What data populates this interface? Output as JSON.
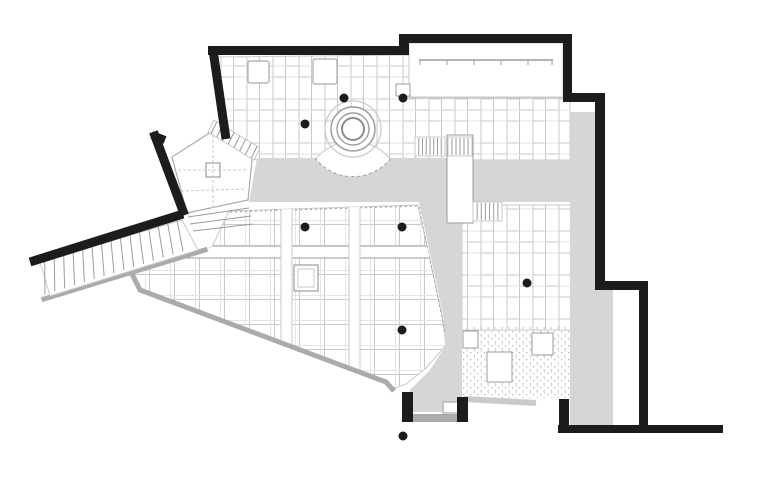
{
  "meta": {
    "content": "architectural floor plan drawing",
    "visible_text": "none"
  },
  "canvas": {
    "width": 768,
    "height": 501,
    "background": "#ffffff"
  },
  "palette": {
    "wall_black": "#1c1c1c",
    "corridor_gray": "#d4d6d8",
    "wall_gray": "#a9abad",
    "shadow_gray": "#c8cacc",
    "line_light": "#c7c9cb",
    "line_lighter": "#e3e5e7",
    "line_mid": "#9a9c9e",
    "stipple_dot": "#b4b6b8",
    "white": "#ffffff"
  },
  "clips": {
    "hall": "M229 211 L418 205 L442 315 L446 345 L426 368 L406 384 L396 388 L140 290 L131 272 L203 251 L212 247 Z"
  },
  "elements": [
    {
      "name": "counter-room-floor",
      "kind": "rect",
      "x": 409,
      "y": 43,
      "w": 154,
      "h": 54,
      "fill": "#ffffff",
      "stroke": "line_light",
      "sw": 1
    },
    {
      "name": "upper-hall-floor",
      "kind": "path",
      "d": "M218 57 L409 55 L409 98 L570 98 L570 160 L391 160 A48 48 0 0 0 315 160 L257 160 L227 141 Z",
      "fill": "pattern:planks",
      "stroke": "line_light",
      "sw": 1
    },
    {
      "name": "right-room-floor",
      "kind": "rect",
      "x": 462,
      "y": 205,
      "w": 110,
      "h": 125,
      "fill": "pattern:planks",
      "stroke": "line_light",
      "sw": 1
    },
    {
      "name": "main-hall-floor",
      "kind": "path",
      "d": "M229 211 L418 205 L442 315 L446 345 L426 368 L406 384 L396 388 L140 290 L131 272 L203 251 L212 247 Z",
      "fill": "pattern:grid",
      "stroke": "line_light",
      "sw": 1
    },
    {
      "name": "terrace-stipple-floor",
      "kind": "rect",
      "x": 461,
      "y": 327,
      "w": 111,
      "h": 71,
      "fill": "pattern:stipple"
    },
    {
      "name": "pentagon-room-floor",
      "kind": "path",
      "d": "M172 157 L222 125 L253 150 L248 200 L187 213 Z",
      "fill": "#ffffff",
      "stroke": "wall_gray",
      "sw": 1.2
    },
    {
      "name": "corridor-band-west",
      "kind": "path",
      "d": "M257 158 L315 158 A48 48 0 0 0 391 158 L447 158 L447 202 L249 202 Z",
      "fill": "corridor_gray"
    },
    {
      "name": "corridor-band-east",
      "kind": "rect",
      "x": 472,
      "y": 160,
      "w": 98,
      "h": 42,
      "fill": "corridor_gray"
    },
    {
      "name": "corridor-strip-east",
      "kind": "path",
      "d": "M570 112 L595 112 L595 290 L613 290 L613 425 L570 425 Z",
      "fill": "corridor_gray"
    },
    {
      "name": "corridor-central",
      "kind": "path",
      "d": "M419 202 L462 202 L462 412 L412 412 L410 390 L430 370 L446 345 L443 315 Z",
      "fill": "corridor_gray"
    },
    {
      "name": "hall-north-dashed-edge",
      "kind": "line",
      "x1": 230,
      "y1": 212,
      "x2": 418,
      "y2": 206,
      "stroke": "line_mid",
      "sw": 1,
      "dash": "2 3"
    },
    {
      "name": "hall-east-dashed-edge",
      "kind": "line",
      "x1": 419,
      "y1": 207,
      "x2": 445,
      "y2": 332,
      "stroke": "line_mid",
      "sw": 1,
      "dash": "2 3"
    },
    {
      "name": "hall-beam-horizontal",
      "kind": "rect",
      "x": 140,
      "y": 246,
      "w": 308,
      "h": 12,
      "fill": "#ffffff",
      "stroke": "line_mid",
      "sw": 1,
      "clip": "hall"
    },
    {
      "name": "hall-beam-vertical-west",
      "kind": "rect",
      "x": 281,
      "y": 206,
      "w": 11,
      "h": 180,
      "fill": "#ffffff",
      "stroke": "line_light",
      "sw": 1,
      "clip": "hall"
    },
    {
      "name": "hall-beam-vertical-east",
      "kind": "rect",
      "x": 349,
      "y": 205,
      "w": 11,
      "h": 182,
      "fill": "#ffffff",
      "stroke": "line_light",
      "sw": 1,
      "clip": "hall"
    },
    {
      "name": "rotunda-dashed-arc",
      "kind": "path",
      "d": "M315 158 A48 48 0 0 0 391 158",
      "fill": null,
      "stroke": "line_mid",
      "sw": 1,
      "dash": "3 3"
    },
    {
      "name": "rotunda-outer-circle",
      "kind": "circle",
      "cx": 353,
      "cy": 129,
      "r": 28,
      "fill": "none",
      "stroke": "line_light",
      "sw": 1.2
    },
    {
      "name": "rotunda-ring-circle",
      "kind": "circle",
      "cx": 353,
      "cy": 129,
      "r": 22,
      "fill": "#ffffff",
      "stroke": "line_mid",
      "sw": 1.4
    },
    {
      "name": "rotunda-mid-circle",
      "kind": "circle",
      "cx": 353,
      "cy": 129,
      "r": 16,
      "fill": "#ffffff",
      "stroke": "line_mid",
      "sw": 1.4
    },
    {
      "name": "rotunda-inner-circle",
      "kind": "circle",
      "cx": 353,
      "cy": 129,
      "r": 11,
      "fill": "#ffffff",
      "stroke": "#8a8c8e",
      "sw": 2
    },
    {
      "name": "ramp-lower-wall",
      "kind": "line",
      "x1": 44,
      "y1": 299,
      "x2": 205,
      "y2": 250,
      "stroke": "wall_gray",
      "sw": 5,
      "cap": "square"
    },
    {
      "name": "hall-lower-wall",
      "kind": "polyline",
      "pts": "131,272 140,290 386,382 394,391",
      "stroke": "wall_gray",
      "sw": 5
    },
    {
      "name": "vestibule-threshold",
      "kind": "line",
      "x1": 413,
      "y1": 418,
      "x2": 459,
      "y2": 418,
      "stroke": "wall_gray",
      "sw": 8
    },
    {
      "name": "entry-shadow-line",
      "kind": "line",
      "x1": 464,
      "y1": 399,
      "x2": 536,
      "y2": 403,
      "stroke": "shadow_gray",
      "sw": 6
    },
    {
      "name": "ramp-stair-hatch",
      "kind": "hatch",
      "quad": [
        [
          40,
          262
        ],
        [
          182,
          220
        ],
        [
          198,
          250
        ],
        [
          50,
          296
        ]
      ],
      "n": 15,
      "slant": -10,
      "fill": "#ffffff",
      "stroke": "line_light",
      "lineStroke": "line_mid"
    },
    {
      "name": "pentagon-stair-hatch",
      "kind": "hatch",
      "quad": [
        [
          214,
          120
        ],
        [
          260,
          148
        ],
        [
          254,
          160
        ],
        [
          208,
          132
        ]
      ],
      "n": 8,
      "slant": 0,
      "fill": "#ffffff",
      "stroke": "line_light",
      "lineStroke": "line_mid"
    },
    {
      "name": "pentagon-lower-steps",
      "kind": "path",
      "d": "M188 217 L249 208 M190 224 L251 216 M193 231 L253 224",
      "fill": null,
      "stroke": "line_mid",
      "sw": 1
    },
    {
      "name": "bridge-walkway",
      "kind": "rect",
      "x": 447,
      "y": 135,
      "w": 26,
      "h": 88,
      "fill": "#ffffff",
      "stroke": "line_mid",
      "sw": 1
    },
    {
      "name": "bridge-west-steps",
      "kind": "vlines",
      "x": 415,
      "y": 137,
      "w": 30,
      "h": 19,
      "n": 7
    },
    {
      "name": "bridge-top-steps",
      "kind": "vlines",
      "x": 448,
      "y": 137,
      "w": 24,
      "h": 19,
      "n": 5
    },
    {
      "name": "right-room-steps",
      "kind": "vlines",
      "x": 473,
      "y": 202,
      "w": 29,
      "h": 19,
      "n": 6
    },
    {
      "name": "upper-hall-table-west",
      "kind": "rect",
      "x": 248,
      "y": 61,
      "w": 21,
      "h": 22,
      "rx": 2,
      "fill": "#ffffff",
      "stroke": "wall_gray",
      "sw": 1.2
    },
    {
      "name": "upper-hall-table-east",
      "kind": "rect",
      "x": 313,
      "y": 59,
      "w": 24,
      "h": 25,
      "rx": 2,
      "fill": "#ffffff",
      "stroke": "wall_gray",
      "sw": 1.2
    },
    {
      "name": "upper-hall-table-small",
      "kind": "rect",
      "x": 396,
      "y": 84,
      "w": 14,
      "h": 12,
      "fill": "#ffffff",
      "stroke": "line_mid",
      "sw": 1
    },
    {
      "name": "hall-center-table",
      "kind": "rect",
      "x": 294,
      "y": 265,
      "w": 24,
      "h": 26,
      "fill": "#ffffff",
      "stroke": "line_mid",
      "sw": 1.2
    },
    {
      "name": "hall-center-table-inner",
      "kind": "rect",
      "x": 298,
      "y": 269,
      "w": 16,
      "h": 18,
      "fill": "#ffffff",
      "stroke": "line_light",
      "sw": 1
    },
    {
      "name": "pentagon-table",
      "kind": "rect",
      "x": 206,
      "y": 163,
      "w": 14,
      "h": 14,
      "fill": "#ffffff",
      "stroke": "line_mid",
      "sw": 1.2
    },
    {
      "name": "pentagon-guide-dashes",
      "kind": "path",
      "d": "M178 170 L246 170 M213 130 L213 208 M181 191 L246 189",
      "fill": null,
      "stroke": "line_light",
      "sw": 1,
      "dash": "3 2"
    },
    {
      "name": "terrace-table-large",
      "kind": "rect",
      "x": 487,
      "y": 352,
      "w": 25,
      "h": 30,
      "fill": "#ffffff",
      "stroke": "line_mid",
      "sw": 1
    },
    {
      "name": "terrace-table-mid",
      "kind": "rect",
      "x": 532,
      "y": 333,
      "w": 21,
      "h": 22,
      "fill": "#ffffff",
      "stroke": "line_mid",
      "sw": 1
    },
    {
      "name": "terrace-table-small",
      "kind": "rect",
      "x": 463,
      "y": 331,
      "w": 15,
      "h": 17,
      "fill": "#ffffff",
      "stroke": "line_mid",
      "sw": 1
    },
    {
      "name": "entry-door-leaf",
      "kind": "rect",
      "x": 443,
      "y": 402,
      "w": 15,
      "h": 11,
      "fill": "#ffffff",
      "stroke": "line_mid",
      "sw": 1
    },
    {
      "name": "counter-line",
      "kind": "ticks",
      "x1": 419,
      "x2": 553,
      "y": 60,
      "len": 5,
      "xs": [
        420,
        447,
        474,
        501,
        528,
        552
      ]
    },
    {
      "name": "wall-top-west",
      "kind": "rect",
      "x": 208,
      "y": 46,
      "w": 196,
      "h": 9,
      "fill": "wall_black"
    },
    {
      "name": "wall-top-step",
      "kind": "rect",
      "x": 399,
      "y": 34,
      "w": 10,
      "h": 21,
      "fill": "wall_black"
    },
    {
      "name": "wall-top-east",
      "kind": "rect",
      "x": 404,
      "y": 34,
      "w": 168,
      "h": 9,
      "fill": "wall_black"
    },
    {
      "name": "wall-east-upper",
      "kind": "rect",
      "x": 563,
      "y": 34,
      "w": 9,
      "h": 68,
      "fill": "wall_black"
    },
    {
      "name": "wall-jog-upper",
      "kind": "rect",
      "x": 563,
      "y": 93,
      "w": 42,
      "h": 9,
      "fill": "wall_black"
    },
    {
      "name": "wall-east-mid",
      "kind": "rect",
      "x": 595,
      "y": 93,
      "w": 10,
      "h": 197,
      "fill": "wall_black"
    },
    {
      "name": "wall-jog-lower",
      "kind": "rect",
      "x": 595,
      "y": 281,
      "w": 53,
      "h": 9,
      "fill": "wall_black"
    },
    {
      "name": "wall-east-lower",
      "kind": "rect",
      "x": 639,
      "y": 281,
      "w": 9,
      "h": 152,
      "fill": "wall_black"
    },
    {
      "name": "wall-south",
      "kind": "rect",
      "x": 558,
      "y": 425,
      "w": 165,
      "h": 8,
      "fill": "wall_black"
    },
    {
      "name": "wall-south-stub",
      "kind": "rect",
      "x": 559,
      "y": 399,
      "w": 10,
      "h": 28,
      "fill": "wall_black"
    },
    {
      "name": "vestibule-wall-west",
      "kind": "rect",
      "x": 402,
      "y": 392,
      "w": 11,
      "h": 30,
      "fill": "wall_black"
    },
    {
      "name": "vestibule-wall-east",
      "kind": "rect",
      "x": 457,
      "y": 397,
      "w": 11,
      "h": 25,
      "fill": "wall_black"
    },
    {
      "name": "wall-northwest-diagonal",
      "kind": "line",
      "x1": 213,
      "y1": 50,
      "x2": 226,
      "y2": 139,
      "stroke": "wall_black",
      "sw": 9
    },
    {
      "name": "wall-west-diagonal",
      "kind": "line",
      "x1": 155,
      "y1": 136,
      "x2": 183,
      "y2": 211,
      "stroke": "wall_black",
      "sw": 9,
      "cap": "square"
    },
    {
      "name": "wall-west-diagonal-cap",
      "kind": "line",
      "x1": 152,
      "y1": 135,
      "x2": 165,
      "y2": 140,
      "stroke": "wall_black",
      "sw": 8
    },
    {
      "name": "ramp-upper-wall",
      "kind": "line",
      "x1": 30,
      "y1": 262,
      "x2": 183,
      "y2": 214,
      "stroke": "wall_black",
      "sw": 9
    },
    {
      "name": "structural-columns",
      "kind": "dots",
      "r": 4.5,
      "fill": "wall_black",
      "pts": [
        [
          305,
          124
        ],
        [
          344,
          98
        ],
        [
          403,
          98
        ],
        [
          305,
          227
        ],
        [
          402,
          227
        ],
        [
          402,
          330
        ],
        [
          527,
          283
        ],
        [
          403,
          436
        ]
      ]
    }
  ]
}
